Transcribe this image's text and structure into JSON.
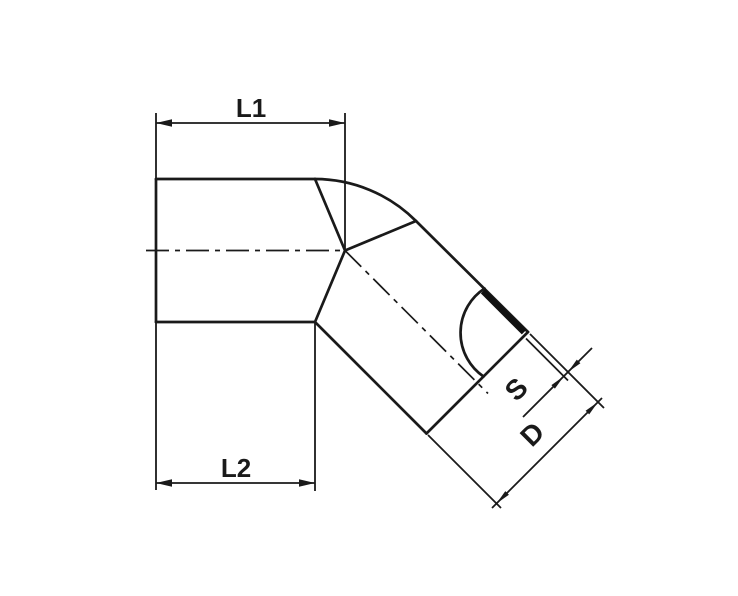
{
  "labels": {
    "l1": "L1",
    "l2": "L2",
    "s": "S",
    "d": "D"
  },
  "colors": {
    "line": "#1a1a1a",
    "background": "#ffffff",
    "section_fill": "#111111"
  }
}
